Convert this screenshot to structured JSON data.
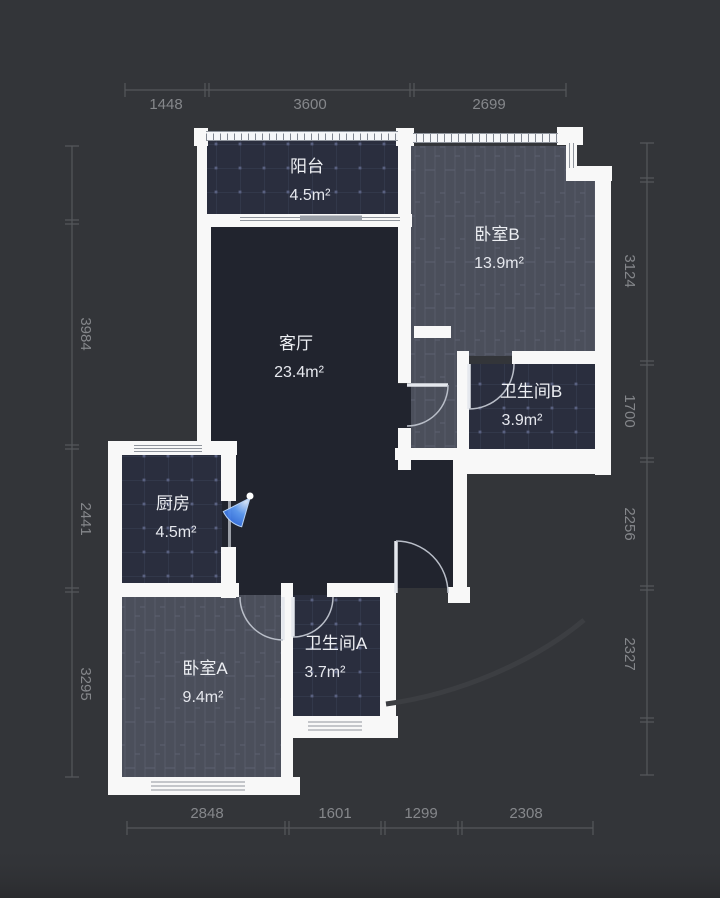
{
  "page": {
    "type": "floorplan",
    "background": "#333539",
    "wall_color": "#f8f8f8"
  },
  "rooms": [
    {
      "id": "balcony",
      "name": "阳台",
      "area": "4.5m²",
      "floor": "tile"
    },
    {
      "id": "bedroom-b",
      "name": "卧室B",
      "area": "13.9m²",
      "floor": "wood"
    },
    {
      "id": "living-room",
      "name": "客厅",
      "area": "23.4m²",
      "floor": "dark"
    },
    {
      "id": "bathroom-b",
      "name": "卫生间B",
      "area": "3.9m²",
      "floor": "tile"
    },
    {
      "id": "kitchen",
      "name": "厨房",
      "area": "4.5m²",
      "floor": "tile"
    },
    {
      "id": "bathroom-a",
      "name": "卫生间A",
      "area": "3.7m²",
      "floor": "tile"
    },
    {
      "id": "bedroom-a",
      "name": "卧室A",
      "area": "9.4m²",
      "floor": "wood"
    }
  ],
  "dimensions_mm": {
    "top": [
      "1448",
      "3600",
      "2699"
    ],
    "bottom": [
      "2848",
      "1601",
      "1299",
      "2308"
    ],
    "left": [
      "3984",
      "2441",
      "3295"
    ],
    "right": [
      "3124",
      "1700",
      "2256",
      "2327"
    ]
  },
  "icons": [
    {
      "name": "camera-viewpoint",
      "color": "#3b82f6"
    }
  ],
  "colors": {
    "background": "#333539",
    "wall": "#f8f8f8",
    "living_floor": "#21242e",
    "tile_floor": "#2a2e3e",
    "wood_floor": "#4b4f5b",
    "dimension_text": "#85878b",
    "room_text": "#edeff3",
    "door_arc": "#b9bec8",
    "camera_blue": "#3b82f6"
  }
}
